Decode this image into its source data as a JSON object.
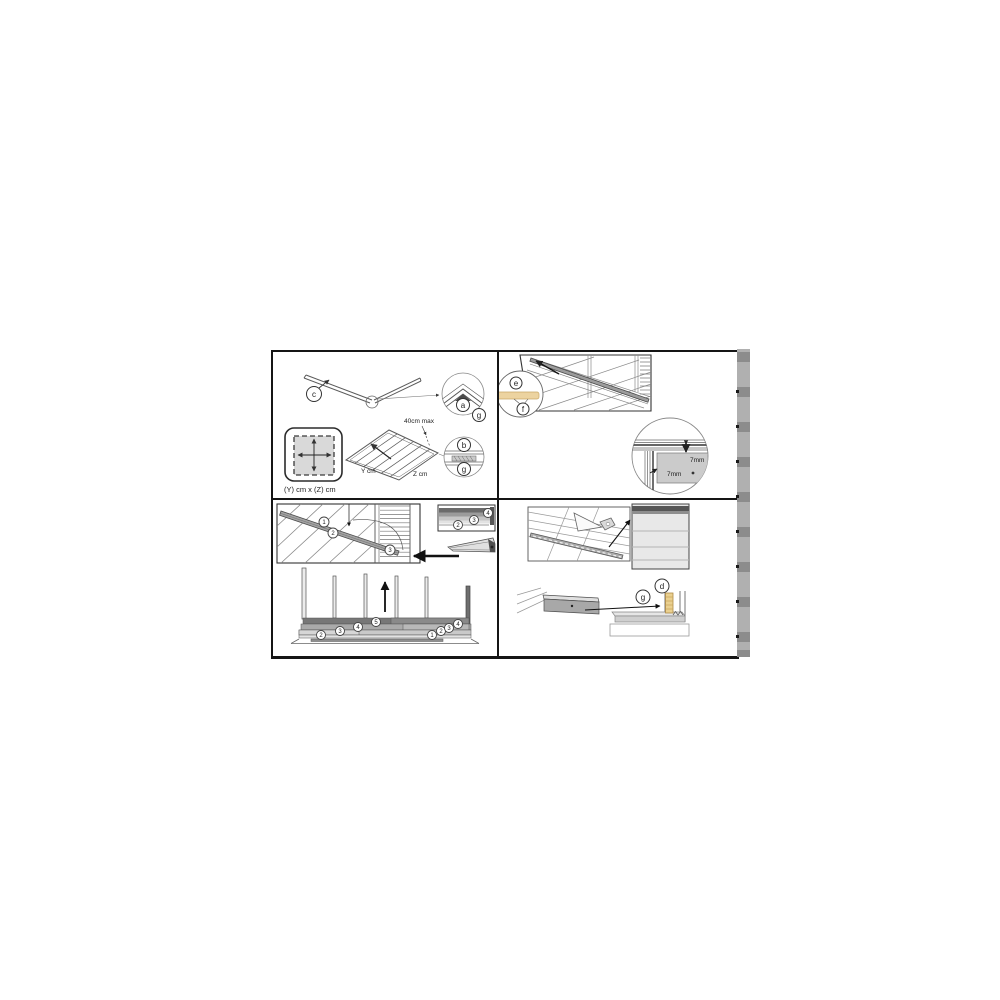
{
  "figure": {
    "type": "assembly-instruction-sheet",
    "colors": {
      "panel_border": "#151515",
      "line": "#4a4a4a",
      "gray_fill": "#c9c9c9",
      "dark_fill": "#6e6e6e",
      "tan_batten": "#ead08f",
      "strip_bg": "#b0b0b0",
      "strip_square": "#8c8c8c"
    }
  },
  "panel_top_left": {
    "callouts": {
      "c": "c",
      "a": "a",
      "g_upper": "g",
      "b": "b",
      "g_lower": "g"
    },
    "spacing_label": "40cm max",
    "base_size_label": "(Y) cm x (Z) cm",
    "width_label": "Y cm",
    "depth_label": "Z cm"
  },
  "panel_top_right": {
    "callouts": {
      "e": "e",
      "f": "f"
    },
    "gap_top": "7mm",
    "gap_side": "7mm"
  },
  "panel_bottom_left": {
    "bar_steps": [
      "1",
      "2",
      "3"
    ],
    "strip_steps": [
      "2",
      "3",
      "4"
    ],
    "left_steps": [
      "2",
      "3",
      "4",
      "5"
    ],
    "right_steps": [
      "1",
      "2",
      "3",
      "4"
    ]
  },
  "panel_bottom_right": {
    "callouts": {
      "g": "g",
      "d": "d"
    }
  }
}
